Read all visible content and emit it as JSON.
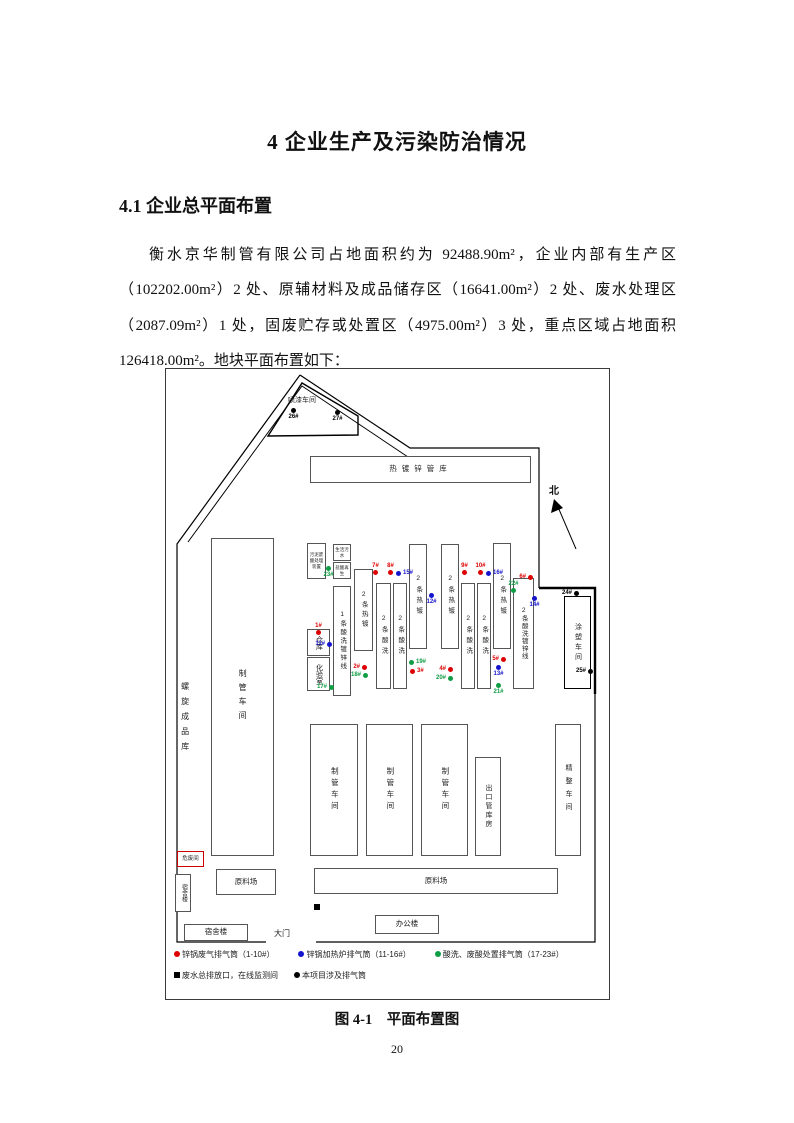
{
  "heading": "4 企业生产及污染防治情况",
  "section_heading": "4.1 企业总平面布置",
  "paragraph": "衡水京华制管有限公司占地面积约为 92488.90m²，企业内部有生产区（102202.00m²）2 处、原辅材料及成品储存区（16641.00m²）2 处、废水处理区（2087.09m²）1 处，固废贮存或处置区（4975.00m²）3 处，重点区域占地面积126418.00m²。地块平面布置如下：",
  "page_number": "20",
  "figure": {
    "caption": "图 4-1　平面布置图",
    "north_label": "北",
    "gate_label": "大门",
    "buildings": {
      "paint_shop": "喷漆车间",
      "galv_pipe_warehouse": "热镀锌管库",
      "spiral_product_warehouse": "螺旋成品库",
      "pipe_workshop": "制管车间",
      "hazardous_waste_room": "危废间",
      "dormitory": "宿舍楼",
      "raw_material_yard": "原料场",
      "office_building": "办公楼",
      "export_pipe_warehouse": "出口管库房",
      "finishing_workshop": "精整车间",
      "coating_workshop": "涂塑车间",
      "warehouse": "仓库",
      "lab": "化验室",
      "sludge_acid_treatment": "污泥废酸处理装置",
      "domestic_sewage": "生活污水",
      "acid_regeneration": "盐酸再生",
      "line1": "1条酸洗镀锌线",
      "line2": "2条酸洗镀锌线",
      "hot_galv_line": "2条热镀",
      "pickling_line": "2条酸洗"
    },
    "stacks": [
      {
        "id": "26#",
        "color": "black",
        "x": 125,
        "y": 39,
        "lpos": "below"
      },
      {
        "id": "27#",
        "color": "black",
        "x": 169,
        "y": 41,
        "lpos": "below"
      },
      {
        "id": "23#",
        "color": "green",
        "x": 160,
        "y": 197,
        "lpos": "below"
      },
      {
        "id": "1#",
        "color": "red",
        "x": 150,
        "y": 261,
        "lpos": "above"
      },
      {
        "id": "11#",
        "color": "blue",
        "x": 161,
        "y": 273,
        "lpos": "left"
      },
      {
        "id": "17#",
        "color": "green",
        "x": 163,
        "y": 316,
        "lpos": "left"
      },
      {
        "id": "7#",
        "color": "red",
        "x": 207,
        "y": 201,
        "lpos": "above"
      },
      {
        "id": "8#",
        "color": "red",
        "x": 222,
        "y": 201,
        "lpos": "above"
      },
      {
        "id": "15#",
        "color": "blue",
        "x": 230,
        "y": 202,
        "lpos": "right"
      },
      {
        "id": "2#",
        "color": "red",
        "x": 196,
        "y": 296,
        "lpos": "left"
      },
      {
        "id": "18#",
        "color": "green",
        "x": 197,
        "y": 304,
        "lpos": "left"
      },
      {
        "id": "19#",
        "color": "green",
        "x": 243,
        "y": 291,
        "lpos": "right"
      },
      {
        "id": "3#",
        "color": "red",
        "x": 244,
        "y": 300,
        "lpos": "right"
      },
      {
        "id": "12#",
        "color": "blue",
        "x": 263,
        "y": 224,
        "lpos": "below"
      },
      {
        "id": "9#",
        "color": "red",
        "x": 296,
        "y": 201,
        "lpos": "above"
      },
      {
        "id": "10#",
        "color": "red",
        "x": 312,
        "y": 201,
        "lpos": "above"
      },
      {
        "id": "16#",
        "color": "blue",
        "x": 320,
        "y": 202,
        "lpos": "right"
      },
      {
        "id": "4#",
        "color": "red",
        "x": 282,
        "y": 298,
        "lpos": "left"
      },
      {
        "id": "20#",
        "color": "green",
        "x": 282,
        "y": 307,
        "lpos": "left"
      },
      {
        "id": "5#",
        "color": "red",
        "x": 335,
        "y": 288,
        "lpos": "left"
      },
      {
        "id": "13#",
        "color": "blue",
        "x": 330,
        "y": 296,
        "lpos": "below"
      },
      {
        "id": "21#",
        "color": "green",
        "x": 330,
        "y": 314,
        "lpos": "below"
      },
      {
        "id": "22#",
        "color": "green",
        "x": 345,
        "y": 219,
        "lpos": "above"
      },
      {
        "id": "6#",
        "color": "red",
        "x": 362,
        "y": 206,
        "lpos": "left"
      },
      {
        "id": "14#",
        "color": "blue",
        "x": 366,
        "y": 227,
        "lpos": "below"
      },
      {
        "id": "24#",
        "color": "black",
        "x": 408,
        "y": 222,
        "lpos": "left"
      },
      {
        "id": "25#",
        "color": "black",
        "x": 422,
        "y": 300,
        "lpos": "left"
      }
    ],
    "legend_row1": [
      {
        "marker": "dot",
        "color": "red",
        "text": "锌锅废气排气筒（1-10#）"
      },
      {
        "marker": "dot",
        "color": "blue",
        "text": "锌锅加热炉排气筒（11-16#）"
      },
      {
        "marker": "dot",
        "color": "green",
        "text": "酸洗、废酸处置排气筒（17-23#）"
      }
    ],
    "legend_row2": [
      {
        "marker": "square",
        "color": "black",
        "text": "废水总排放口，在线监测间"
      },
      {
        "marker": "dot",
        "color": "black",
        "text": "本项目涉及排气筒"
      }
    ]
  },
  "colors": {
    "red": "#dd0000",
    "blue": "#1414cc",
    "green": "#0f9d45",
    "black": "#000000"
  }
}
